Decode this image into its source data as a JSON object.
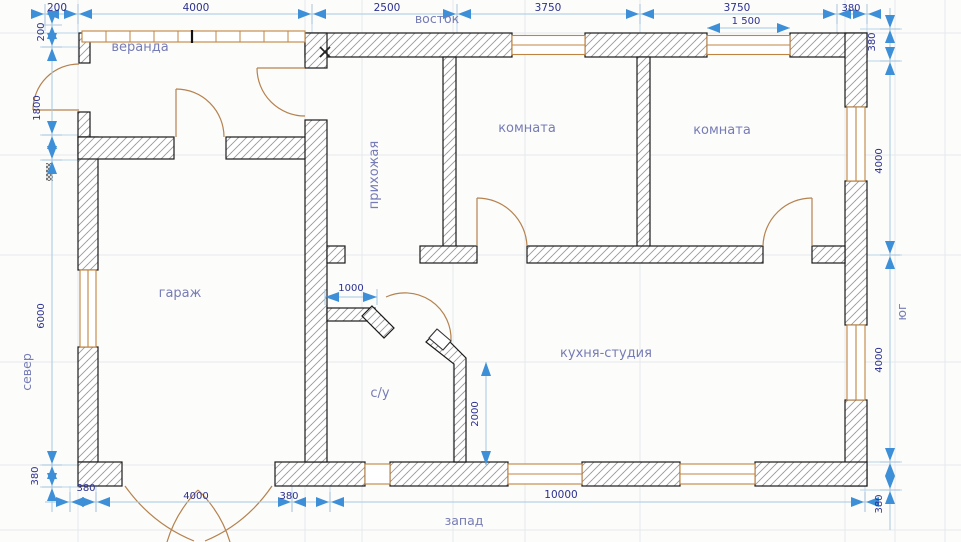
{
  "drawing": {
    "type": "architectural-floor-plan",
    "compass": {
      "east": "восток",
      "west": "запад",
      "north": "север",
      "south": "юг"
    },
    "rooms": {
      "veranda": "веранда",
      "hallway": "прихожая",
      "room1": "комната",
      "room2": "комната",
      "garage": "гараж",
      "kitchen": "кухня-студия",
      "bathroom": "с/у"
    },
    "dimensions": {
      "top": [
        "200",
        "4000",
        "2500",
        "3750",
        "3750",
        "380"
      ],
      "window_width": "1 500",
      "left": [
        "200",
        "1800",
        "6000",
        "380"
      ],
      "right": [
        "380",
        "4000",
        "4000",
        "380"
      ],
      "bottom": [
        "380",
        "4000",
        "380",
        "10000"
      ],
      "bath_wall": "1000",
      "bath_depth": "2000"
    },
    "colors": {
      "background": "#fcfcfa",
      "wall_outline": "#1a1a1a",
      "wall_hatch": "#9a9a9a",
      "joinery": "#c08440",
      "door_swing": "#b5824f",
      "dimension_arrow": "#3d8fd8",
      "dimension_line": "#a6c9e4",
      "dimension_text": "#2c3190",
      "room_label": "#767cb6",
      "grid": "#e4e8ee"
    }
  }
}
